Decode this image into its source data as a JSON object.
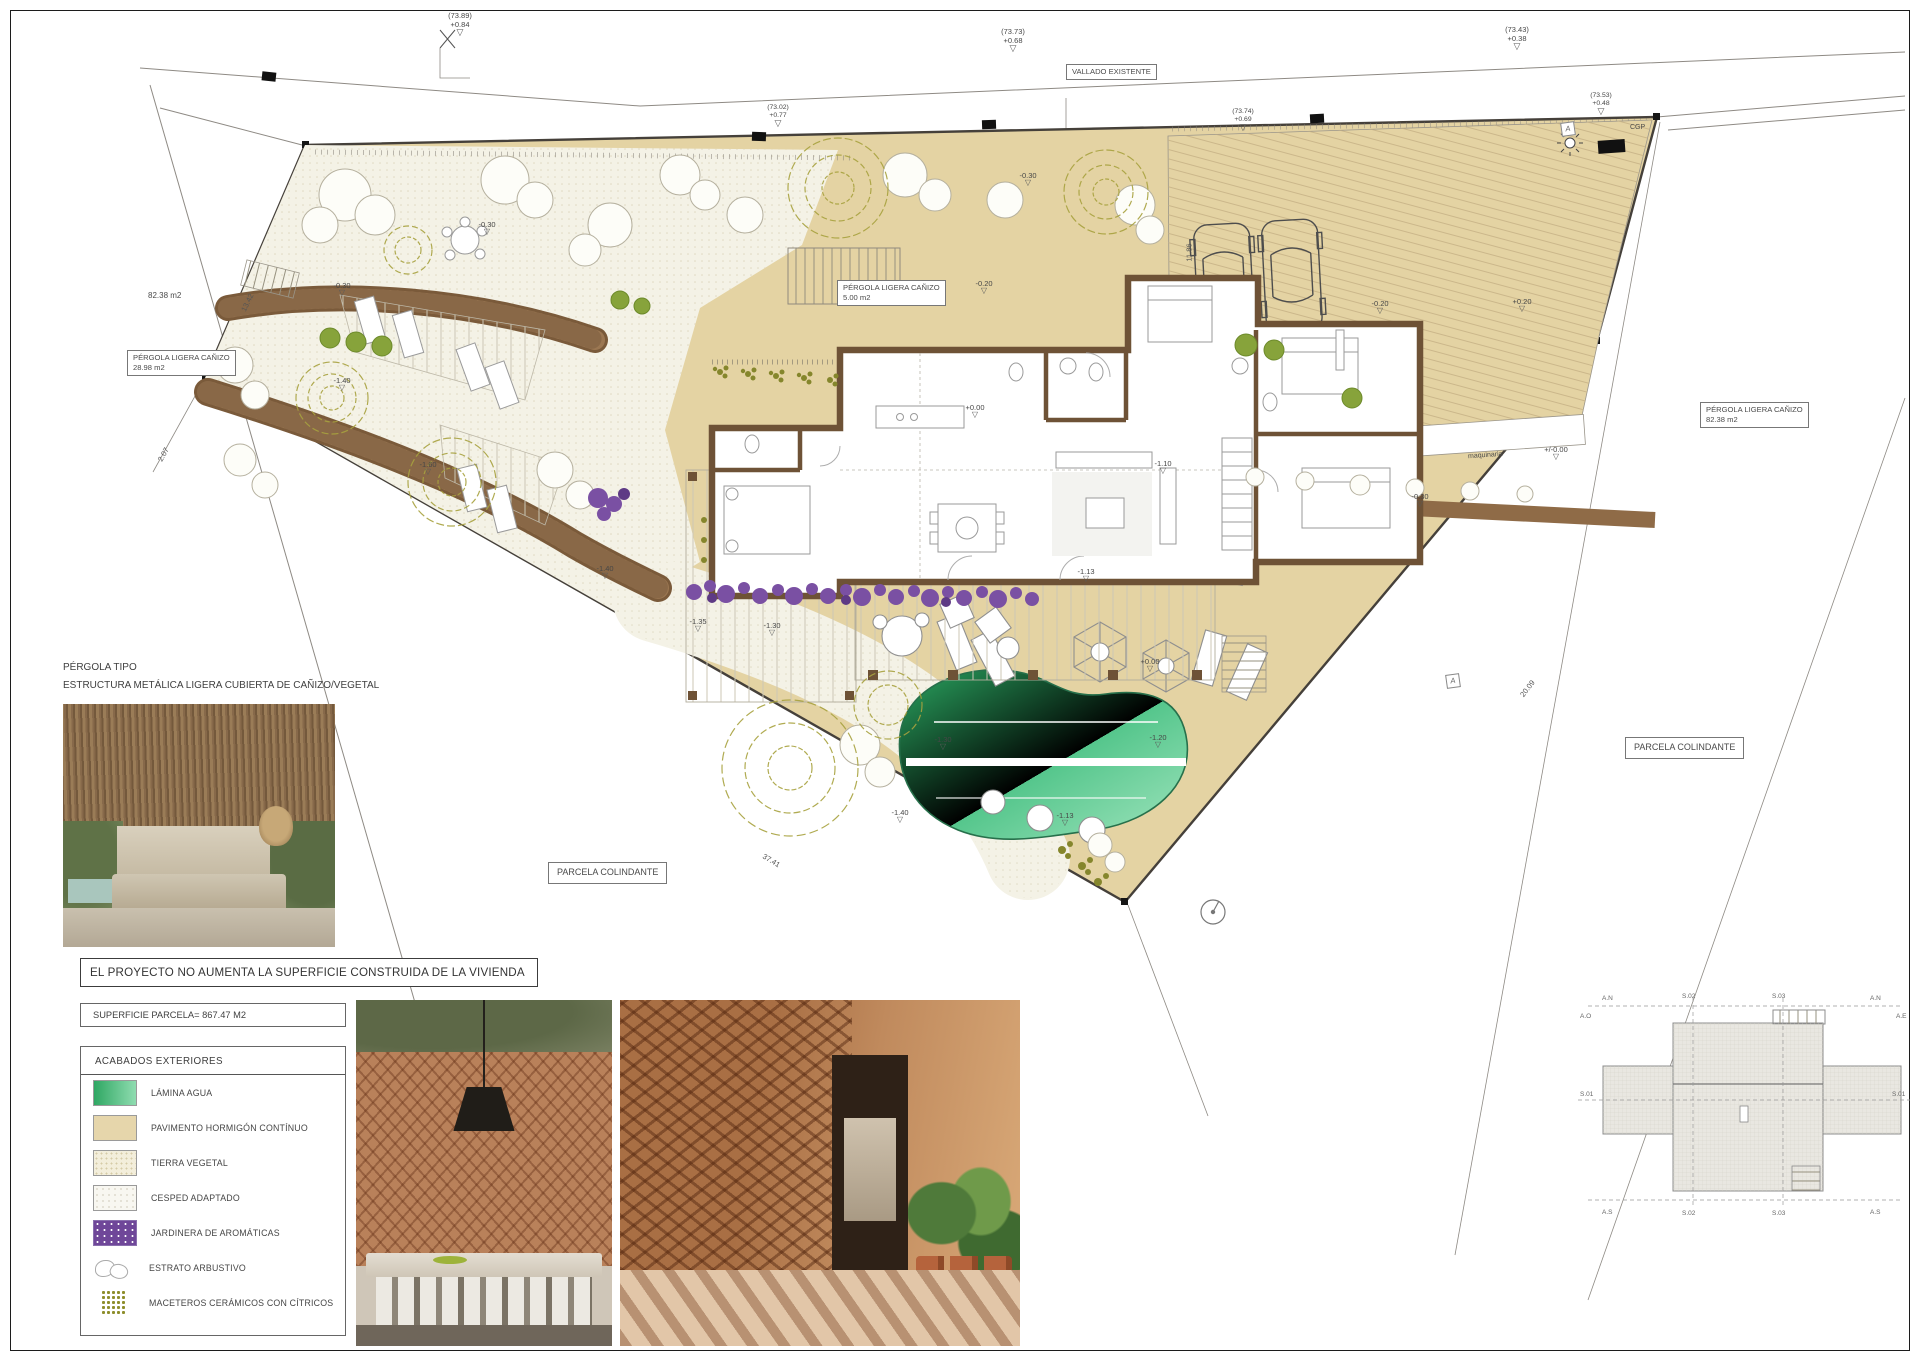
{
  "plan": {
    "spot_elevations": [
      {
        "cota": "(73.89)",
        "delta": "+0.84"
      },
      {
        "cota": "(73.73)",
        "delta": "+0.68"
      },
      {
        "cota": "(73.43)",
        "delta": "+0.38"
      },
      {
        "cota": "(73.02)",
        "delta": "+0.77"
      },
      {
        "cota": "(73.74)",
        "delta": "+0.69"
      },
      {
        "cota": "(73.53)",
        "delta": "+0.48"
      }
    ],
    "utility_label": "CGP",
    "fence_label": "VALLADO EXISTENTE",
    "neighbor_area": "82.38 m2",
    "pergola_boxes": [
      {
        "line1": "PÉRGOLA LIGERA CAÑIZO",
        "line2": "28.98 m2"
      },
      {
        "line1": "PÉRGOLA LIGERA CAÑIZO",
        "line2": "5.00 m2"
      },
      {
        "line1": "PÉRGOLA LIGERA CAÑIZO",
        "line2": "82.38 m2"
      }
    ],
    "parcela_colindante": "PARCELA COLINDANTE",
    "machine_room": "maquinaria",
    "section_marker": "A",
    "levels": [
      "-0.30",
      "-0.30",
      "-0.30",
      "-0.20",
      "-0.20",
      "+0.20",
      "+0.00",
      "+0.00",
      "+/-0.00",
      "-0.30",
      "-1.10",
      "-1.40",
      "-1.60",
      "-1.40",
      "-1.35",
      "-1.30",
      "-1.30",
      "-1.20",
      "-1.40",
      "-1.13",
      "-1.13"
    ],
    "dimensions": [
      "13.42",
      "2.07",
      "37.41",
      "20.09",
      "11.86"
    ]
  },
  "notes": {
    "pergola_type_title": "PÉRGOLA TIPO",
    "pergola_type_desc": "ESTRUCTURA METÁLICA LIGERA CUBIERTA DE CAÑIZO/VEGETAL",
    "statement": "EL PROYECTO NO AUMENTA LA SUPERFICIE CONSTRUIDA DE LA VIVIENDA",
    "plot_area": "SUPERFICIE PARCELA= 867.47 M2"
  },
  "legend": {
    "title": "ACABADOS  EXTERIORES",
    "items": [
      {
        "label": "LÁMINA AGUA"
      },
      {
        "label": "PAVIMENTO HORMIGÓN CONTÍNUO"
      },
      {
        "label": "TIERRA VEGETAL"
      },
      {
        "label": "CESPED ADAPTADO"
      },
      {
        "label": "JARDINERA  DE AROMÁTICAS"
      },
      {
        "label": "ESTRATO ARBUSTIVO"
      },
      {
        "label": "MACETEROS CERÁMICOS CON CÍTRICOS"
      }
    ]
  },
  "roof_plan": {
    "axis_labels": [
      "A.N",
      "A.O",
      "A.E",
      "A.S"
    ],
    "section_labels": [
      "S.01",
      "S.02",
      "S.03"
    ]
  },
  "colors": {
    "pavement": "#e4d3a3",
    "grass": "#f4f2e6",
    "water_dark": "#2fa763",
    "water_light": "#8fdcb0",
    "wall_brown": "#6e5236",
    "path_wood": "#8f6b47",
    "planter_purple": "#7a50a3",
    "olive": "#a8a23f"
  }
}
